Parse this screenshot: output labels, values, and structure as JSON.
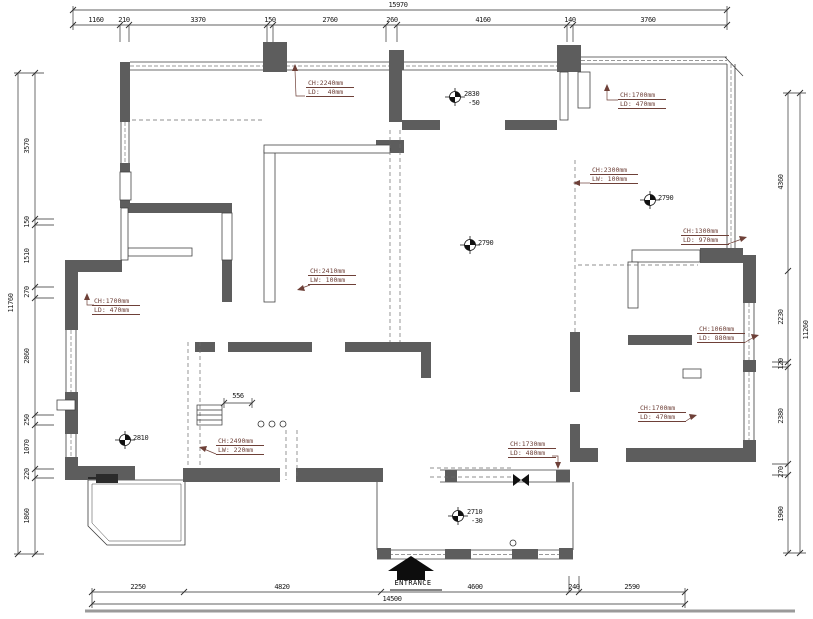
{
  "drawing_type": "floor-plan",
  "entrance": {
    "label": "ENTRANCE"
  },
  "dimensions": {
    "top": {
      "total": "15970",
      "segments": [
        "1160",
        "210",
        "3370",
        "150",
        "2760",
        "260",
        "4160",
        "140",
        "3760"
      ]
    },
    "left": {
      "total": "11760",
      "segments": [
        "3570",
        "150",
        "1510",
        "270",
        "2860",
        "250",
        "1070",
        "220",
        "1860"
      ]
    },
    "right": {
      "total": "11260",
      "segments": [
        "4360",
        "2230",
        "120",
        "2380",
        "270",
        "1900"
      ]
    },
    "bottom": {
      "total": "14500",
      "segments": [
        "2250",
        "4820",
        "4600",
        "240",
        "2590"
      ]
    },
    "stair_width": "556"
  },
  "ceiling_labels": [
    {
      "ch": "CH:2240mm",
      "sub": "LD:  40mm"
    },
    {
      "ch": "CH:1700mm",
      "sub": "LD: 470mm"
    },
    {
      "ch": "CH:2300mm",
      "sub": "LW: 100mm"
    },
    {
      "ch": "CH:1300mm",
      "sub": "LD: 970mm"
    },
    {
      "ch": "CH:2410mm",
      "sub": "LW: 100mm"
    },
    {
      "ch": "CH:1700mm",
      "sub": "LD: 470mm"
    },
    {
      "ch": "CH:1060mm",
      "sub": "LD: 880mm"
    },
    {
      "ch": "CH:1700mm",
      "sub": "LD: 470mm"
    },
    {
      "ch": "CH:2490mm",
      "sub": "LW: 220mm"
    },
    {
      "ch": "CH:1730mm",
      "sub": "LD: 480mm"
    }
  ],
  "level_markers": [
    {
      "value": "2830",
      "offset": "-50"
    },
    {
      "value": "2790"
    },
    {
      "value": "2790"
    },
    {
      "value": "2810"
    },
    {
      "value": "2710",
      "offset": "-30"
    }
  ],
  "colors": {
    "wall": "#5d5d5d",
    "line": "#3c3c3c",
    "annotation": "#6e4038",
    "dimension_text": "#1a1a1a",
    "background": "#ffffff"
  }
}
